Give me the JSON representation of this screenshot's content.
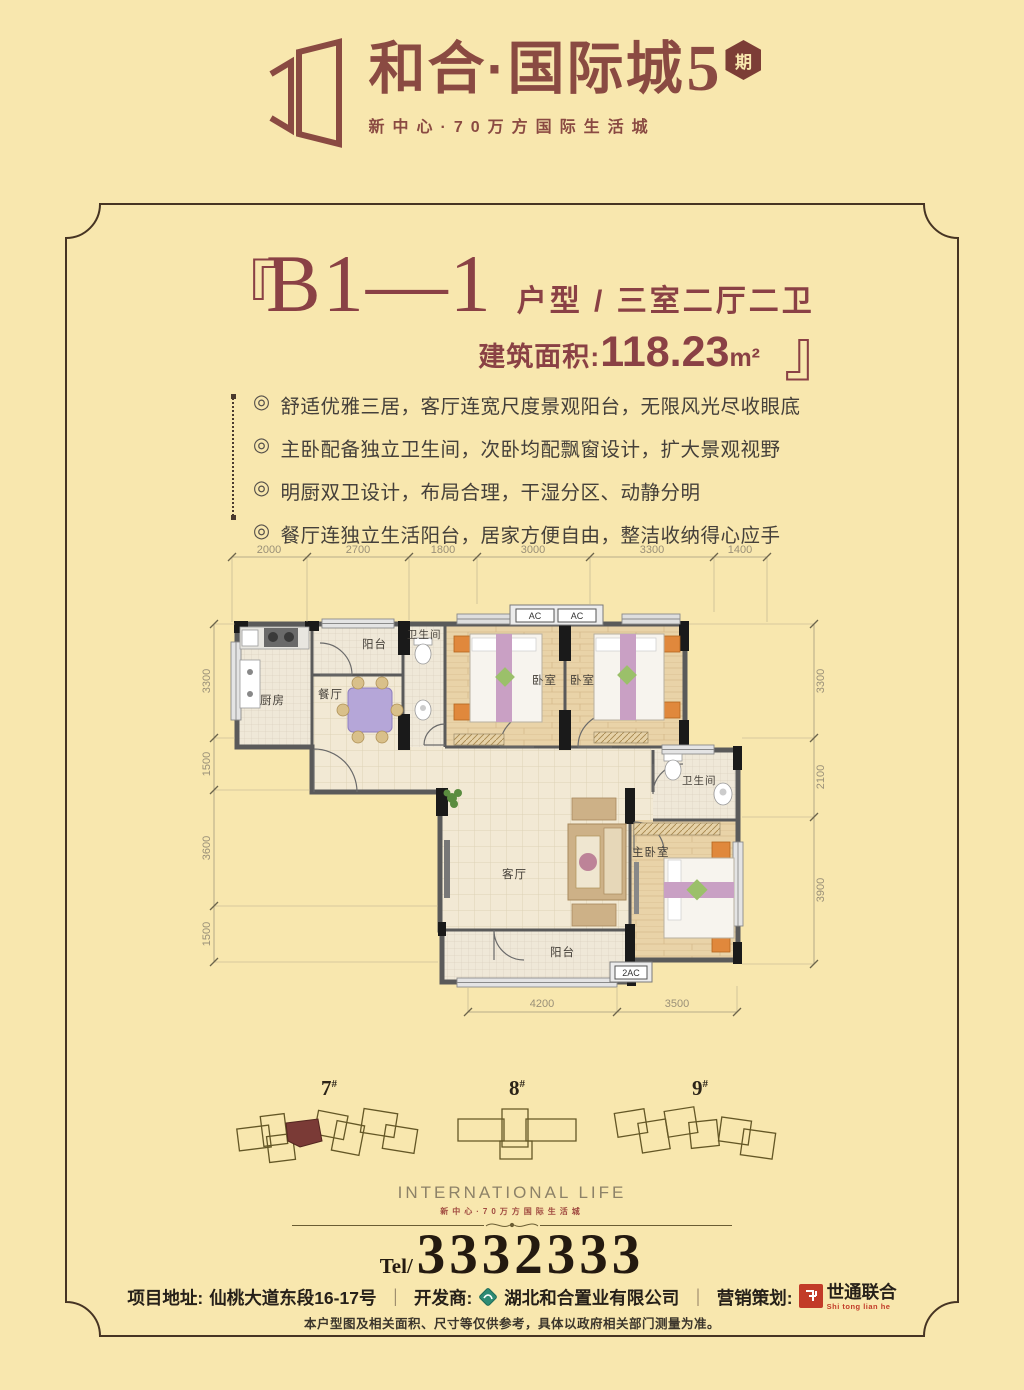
{
  "header": {
    "brand_main": "和合·国际城",
    "brand_num": "5",
    "badge": "期",
    "tagline": "新中心·70万方国际生活城"
  },
  "title": {
    "bracket_open": "『",
    "bracket_close": "』",
    "unit": "B1—1",
    "type_label": "户型 / 三室二厅二卫",
    "area_label": "建筑面积:",
    "area_value": "118.23",
    "area_unit": "m²"
  },
  "bullet_glyph": "◎",
  "features": [
    "舒适优雅三居，客厅连宽尺度景观阳台，无限风光尽收眼底",
    "主卧配备独立卫生间，次卧均配飘窗设计，扩大景观视野",
    "明厨双卫设计，布局合理，干湿分区、动静分明",
    "餐厅连独立生活阳台，居家方便自由，整洁收纳得心应手"
  ],
  "plan": {
    "rooms": {
      "kitchen": "厨房",
      "dining": "餐厅",
      "balcony_top": "阳台",
      "bath1": "卫生间",
      "bedroom1": "卧室",
      "bedroom2": "卧室",
      "bath2": "卫生间",
      "master": "主卧室",
      "living": "客厅",
      "balcony_bottom": "阳台"
    },
    "ac1": "AC",
    "ac2": "AC",
    "ac3": "2AC",
    "dims_top": [
      "2000",
      "2700",
      "1800",
      "3000",
      "3300",
      "1400"
    ],
    "dims_left": [
      "3300",
      "1500",
      "3600",
      "1500"
    ],
    "dims_right": [
      "3300",
      "2100",
      "3900"
    ],
    "dims_bottom": [
      "4200",
      "3500"
    ]
  },
  "buildings": {
    "hash": "#",
    "items": [
      {
        "num": "7"
      },
      {
        "num": "8"
      },
      {
        "num": "9"
      }
    ]
  },
  "footer": {
    "intl": "INTERNATIONAL LIFE",
    "intl_sub": "新中心·70万方国际生活城",
    "tel_label": "Tel/",
    "tel_number": "3332333",
    "address_label": "项目地址:",
    "address_value": "仙桃大道东段16-17号",
    "sep": "｜",
    "developer_label": "开发商:",
    "developer_value": "湖北和合置业有限公司",
    "agency_label": "营销策划:",
    "agency_value": "世通联合",
    "agency_sub": "Shi tong lian he",
    "disclaimer": "本户型图及相关面积、尺寸等仅供参考，具体以政府相关部门测量为准。"
  },
  "colors": {
    "background": "#f8e7ae",
    "brand_brown": "#8a4a42",
    "title_red": "#8a4145",
    "dark_text": "#241a10",
    "agency_red": "#c23b28",
    "highlight_unit": "#7a3a36"
  }
}
